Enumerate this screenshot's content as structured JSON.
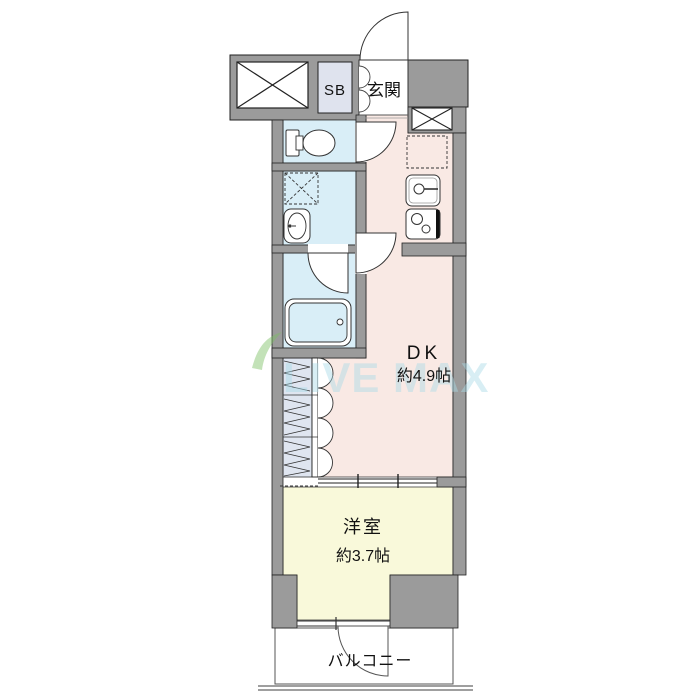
{
  "floorplan": {
    "rooms": {
      "entrance": {
        "label": "玄関"
      },
      "shoe_box": {
        "label": "SB"
      },
      "dining_kitchen": {
        "label": "DK",
        "size": "約4.9帖"
      },
      "western_room": {
        "label": "洋室",
        "size": "約3.7帖"
      },
      "balcony": {
        "label": "バルコニー"
      }
    },
    "watermark": {
      "text": "LIVE MAX"
    },
    "fixtures": [
      "shaft-x-icon-top-left",
      "shaft-x-icon-right",
      "toilet-icon",
      "washing-machine-space-icon",
      "washbasin-icon",
      "bathtub-icon",
      "refrigerator-space-icon",
      "kitchen-sink-icon",
      "stove-icon",
      "closet-hatch-icon",
      "door-swing-icons",
      "sliding-door-icon",
      "window-icon"
    ],
    "colors": {
      "wall_gray": "#9b9b9b",
      "outline": "#222222",
      "dk_pink": "#f9e9e4",
      "western_room_yellow": "#f9f9da",
      "wet_area_blue": "#d9eef7",
      "closet_blue_gray": "#dfe5f0",
      "shoe_box_fill": "#dfe3ee",
      "watermark_blue": "#aadbe8",
      "watermark_leaf_green": "#7cbf63"
    }
  }
}
